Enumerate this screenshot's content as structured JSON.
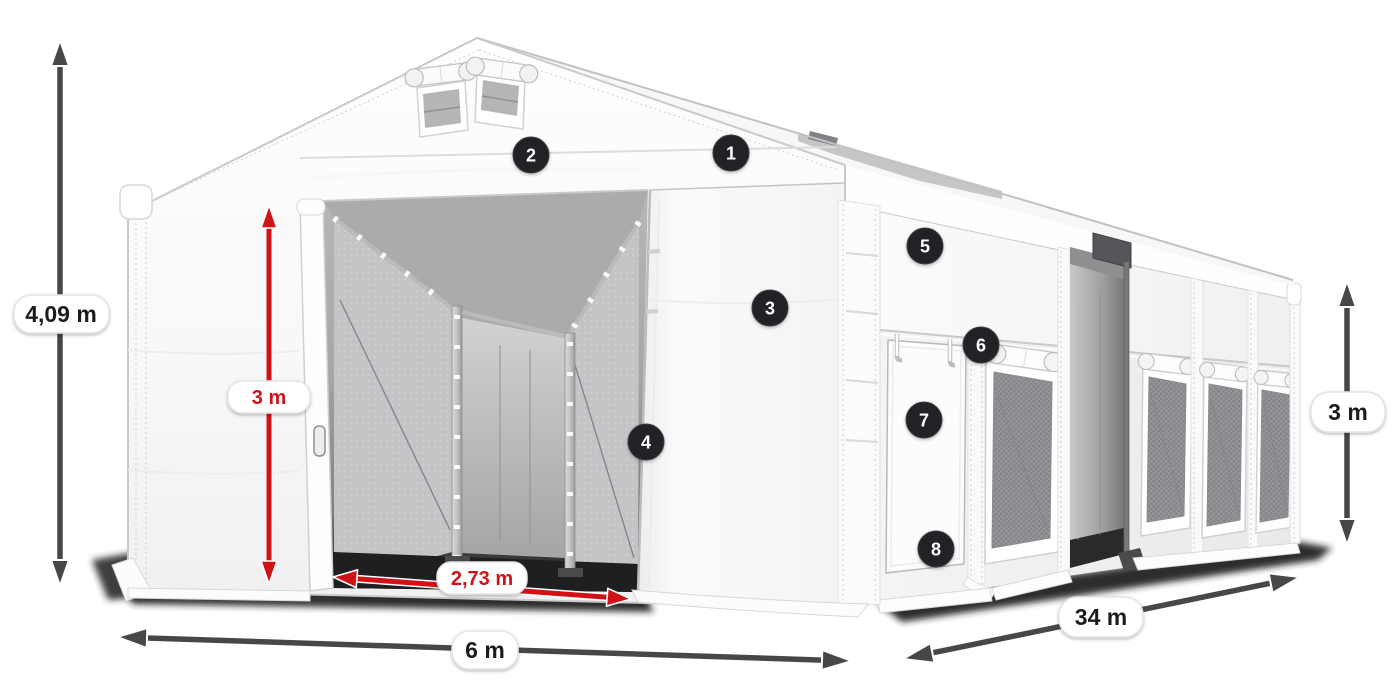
{
  "diagram": {
    "type": "tent-product-dimension-diagram",
    "dimensions": {
      "total_height": {
        "label": "4,09 m"
      },
      "door_height": {
        "label": "3 m"
      },
      "door_width": {
        "label": "2,73 m"
      },
      "front_width": {
        "label": "6 m"
      },
      "side_length": {
        "label": "34 m"
      },
      "side_height": {
        "label": "3 m"
      }
    },
    "markers": [
      {
        "number": "1"
      },
      {
        "number": "2"
      },
      {
        "number": "3"
      },
      {
        "number": "4"
      },
      {
        "number": "5"
      },
      {
        "number": "6"
      },
      {
        "number": "7"
      },
      {
        "number": "8"
      }
    ],
    "colors": {
      "dimension_red": "#d01217",
      "dimension_dark": "#474747",
      "marker_bg": "#232326",
      "pill_bg": "#ffffff",
      "tent_white": "#fdfdfe"
    }
  }
}
